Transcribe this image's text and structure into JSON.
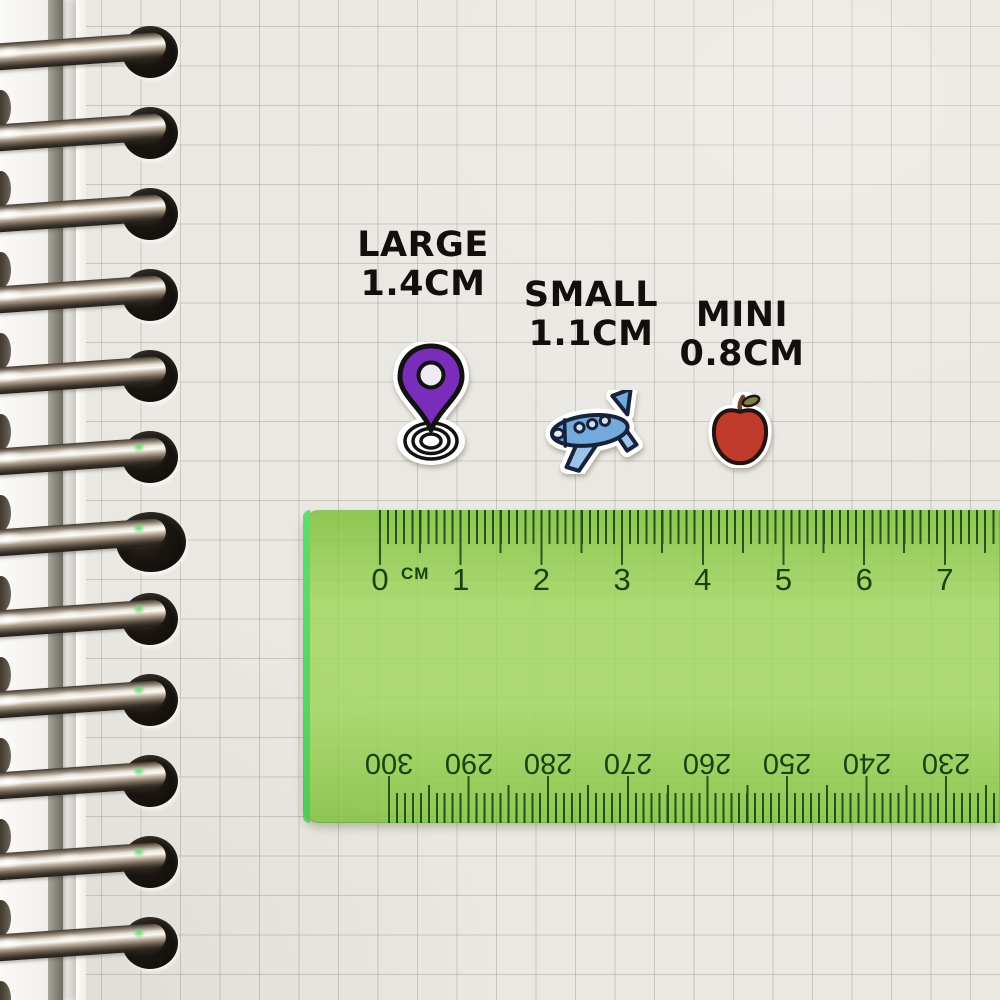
{
  "scene": {
    "description": "Sticker size comparison chart on a spiral grid notebook with a transparent green ruler"
  },
  "labels": {
    "large_name": "LARGE",
    "large_size": "1.4CM",
    "small_name": "SMALL",
    "small_size": "1.1CM",
    "mini_name": "MINI",
    "mini_size": "0.8CM"
  },
  "stickers": {
    "pin": {
      "icon": "location-pin-sticker",
      "size_label": "1.4CM"
    },
    "plane": {
      "icon": "airplane-sticker",
      "size_label": "1.1CM"
    },
    "apple": {
      "icon": "apple-sticker",
      "size_label": "0.8CM"
    }
  },
  "ruler": {
    "unit_label": "CM",
    "top_numbers": [
      "0",
      "1",
      "2",
      "3",
      "4",
      "5",
      "6",
      "7"
    ],
    "bottom_numbers": [
      "300",
      "290",
      "280",
      "270",
      "260",
      "250",
      "240",
      "230"
    ]
  },
  "colors": {
    "pin_purple": "#7a2dbb",
    "pin_inner": "#efe9f4",
    "plane_blue": "#74a9dc",
    "plane_light": "#9cc3ea",
    "plane_window": "#cfe2f4",
    "plane_outline": "#18223b",
    "apple_red": "#c03a2b",
    "apple_leaf": "#7b8444",
    "apple_stem": "#6d4226",
    "ruler_green": "rgba(141,206,63,0.80)",
    "ruler_ink": "#17430f",
    "label_ink": "#12100e"
  }
}
